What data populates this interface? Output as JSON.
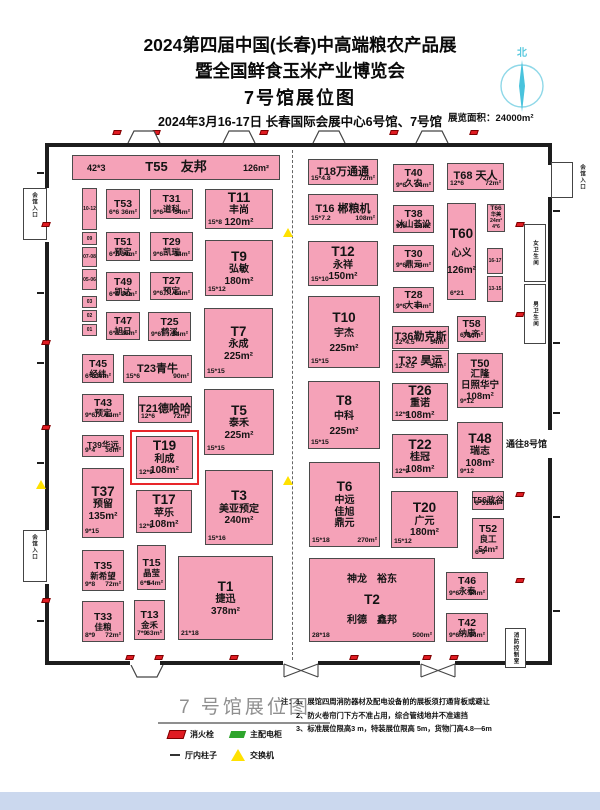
{
  "header": {
    "title_line1": "2024第四届中国(长春)中高端粮农产品展",
    "title_line2": "暨全国鲜食玉米产业博览会",
    "title_line3": "7号馆展位图",
    "date_line": "2024年3月16-17日  长春国际会展中心6号馆、7号馆",
    "area_label": "展览面积：24000m²",
    "compass_label": "北"
  },
  "plan": {
    "booth_fill": "#f5a2b8",
    "highlight_color": "#e8262a",
    "passage_label": "通往8号馆",
    "booths": [
      {
        "id": "T55",
        "x": 72,
        "y": 155,
        "w": 208,
        "h": 25,
        "cls": "banner",
        "lines": [
          "T55　友邦"
        ],
        "bl": "42*3",
        "br": "126m²"
      },
      {
        "id": "T53",
        "x": 106,
        "y": 189,
        "w": 34,
        "h": 30,
        "cls": "s",
        "lines": [
          "T53"
        ],
        "bl": "6*6",
        "br": "36m²"
      },
      {
        "id": "T51",
        "x": 106,
        "y": 232,
        "w": 34,
        "h": 29,
        "cls": "s",
        "lines": [
          "T51",
          "预定"
        ],
        "bl": "6*6",
        "br": "36m²"
      },
      {
        "id": "T49",
        "x": 106,
        "y": 272,
        "w": 34,
        "h": 29,
        "cls": "s",
        "lines": [
          "T49",
          "凯达"
        ],
        "bl": "6*6",
        "br": "36m²"
      },
      {
        "id": "T47",
        "x": 106,
        "y": 312,
        "w": 34,
        "h": 28,
        "cls": "s",
        "lines": [
          "T47",
          "旭日"
        ],
        "bl": "6*6",
        "br": "36m²"
      },
      {
        "id": "T45",
        "x": 82,
        "y": 354,
        "w": 32,
        "h": 29,
        "cls": "s",
        "lines": [
          "T45",
          "经纬"
        ],
        "bl": "6*6",
        "br": "36m²"
      },
      {
        "id": "T43",
        "x": 82,
        "y": 394,
        "w": 42,
        "h": 28,
        "cls": "s",
        "lines": [
          "T43",
          "预定"
        ],
        "bl": "9*6",
        "br": "54m²"
      },
      {
        "id": "T39",
        "x": 82,
        "y": 435,
        "w": 42,
        "h": 22,
        "cls": "tiny2",
        "lines": [
          "T39华远"
        ],
        "bl": "9*4",
        "br": "36m²"
      },
      {
        "id": "T37",
        "x": 82,
        "y": 468,
        "w": 42,
        "h": 70,
        "cls": "l",
        "lines": [
          "T37",
          "预留",
          "135m²"
        ],
        "bl": "9*15"
      },
      {
        "id": "T35",
        "x": 82,
        "y": 550,
        "w": 42,
        "h": 41,
        "cls": "s",
        "lines": [
          "T35",
          "新希望"
        ],
        "bl": "9*8",
        "br": "72m²"
      },
      {
        "id": "T33",
        "x": 82,
        "y": 601,
        "w": 42,
        "h": 41,
        "cls": "s",
        "lines": [
          "T33",
          "佳粮"
        ],
        "bl": "8*9",
        "br": "72m²"
      },
      {
        "id": "T31",
        "x": 150,
        "y": 189,
        "w": 43,
        "h": 30,
        "cls": "s",
        "lines": [
          "T31",
          "道科"
        ],
        "bl": "9*6",
        "br": "54m²"
      },
      {
        "id": "T29",
        "x": 150,
        "y": 232,
        "w": 43,
        "h": 29,
        "cls": "s",
        "lines": [
          "T29",
          "凯瑞"
        ],
        "bl": "9*6",
        "br": "54m²"
      },
      {
        "id": "T27",
        "x": 150,
        "y": 272,
        "w": 43,
        "h": 28,
        "cls": "s",
        "lines": [
          "T27",
          "预定"
        ],
        "bl": "9*6",
        "br": "54m²"
      },
      {
        "id": "T25",
        "x": 148,
        "y": 312,
        "w": 43,
        "h": 29,
        "cls": "s",
        "lines": [
          "T25",
          "鹤溪"
        ],
        "bl": "9*6",
        "br": "54m²"
      },
      {
        "id": "T23",
        "x": 123,
        "y": 355,
        "w": 69,
        "h": 28,
        "cls": "m",
        "lines": [
          "T23青牛"
        ],
        "bl": "15*6",
        "br": "90m²"
      },
      {
        "id": "T21",
        "x": 138,
        "y": 396,
        "w": 54,
        "h": 27,
        "cls": "m",
        "lines": [
          "T21德哈哈"
        ],
        "bl": "12*6",
        "br": "72m²"
      },
      {
        "id": "T19",
        "x": 136,
        "y": 436,
        "w": 57,
        "h": 43,
        "cls": "l",
        "hl": true,
        "lines": [
          "T19",
          "利成",
          "108m²"
        ],
        "bl": "12*9"
      },
      {
        "id": "T17",
        "x": 136,
        "y": 490,
        "w": 56,
        "h": 43,
        "cls": "l",
        "lines": [
          "T17",
          "苹乐",
          "108m²"
        ],
        "bl": "12*9"
      },
      {
        "id": "T15",
        "x": 137,
        "y": 545,
        "w": 29,
        "h": 45,
        "cls": "s",
        "lines": [
          "T15",
          "晶莹"
        ],
        "bl": "6*9",
        "br": "54m²"
      },
      {
        "id": "T13",
        "x": 134,
        "y": 600,
        "w": 31,
        "h": 40,
        "cls": "s",
        "lines": [
          "T13",
          "金禾"
        ],
        "bl": "7*9",
        "br": "63m²"
      },
      {
        "id": "T11",
        "x": 205,
        "y": 189,
        "w": 68,
        "h": 40,
        "cls": "l",
        "lines": [
          "T11",
          "丰尚",
          "120m²"
        ],
        "bl": "15*8"
      },
      {
        "id": "T9",
        "x": 205,
        "y": 240,
        "w": 68,
        "h": 56,
        "cls": "l",
        "lines": [
          "T9",
          "弘敏",
          "180m²"
        ],
        "bl": "15*12"
      },
      {
        "id": "T7",
        "x": 204,
        "y": 308,
        "w": 69,
        "h": 70,
        "cls": "l",
        "lines": [
          "T7",
          "永成",
          "225m²"
        ],
        "bl": "15*15"
      },
      {
        "id": "T5",
        "x": 204,
        "y": 389,
        "w": 70,
        "h": 66,
        "cls": "l",
        "lines": [
          "T5",
          "泰禾",
          "225m²"
        ],
        "bl": "15*15"
      },
      {
        "id": "T3",
        "x": 205,
        "y": 470,
        "w": 68,
        "h": 75,
        "cls": "l",
        "lines": [
          "T3",
          "美亚预定",
          "240m²"
        ],
        "bl": "15*16"
      },
      {
        "id": "T1",
        "x": 178,
        "y": 556,
        "w": 95,
        "h": 84,
        "cls": "l",
        "lines": [
          "T1",
          "捷迅",
          "378m²"
        ],
        "bl": "21*18"
      },
      {
        "id": "T18",
        "x": 308,
        "y": 159,
        "w": 70,
        "h": 26,
        "cls": "m",
        "lines": [
          "T18万通通"
        ],
        "bl": "15*4.8",
        "br": "72m²"
      },
      {
        "id": "T40",
        "x": 393,
        "y": 164,
        "w": 41,
        "h": 28,
        "cls": "s",
        "lines": [
          "T40",
          "久农"
        ],
        "bl": "9*6",
        "br": "54m²"
      },
      {
        "id": "T68",
        "x": 447,
        "y": 163,
        "w": 57,
        "h": 27,
        "cls": "m",
        "lines": [
          "T68 天人"
        ],
        "bl": "12*6",
        "br": "72m²"
      },
      {
        "id": "T16",
        "x": 308,
        "y": 194,
        "w": 70,
        "h": 31,
        "cls": "m",
        "lines": [
          "T16 郴粮机"
        ],
        "bl": "15*7.2",
        "br": "108m²"
      },
      {
        "id": "T38",
        "x": 393,
        "y": 205,
        "w": 41,
        "h": 28,
        "cls": "s",
        "lines": [
          "T38",
          "冰山荟设"
        ],
        "bl": "9*6",
        "br": "54m²"
      },
      {
        "id": "T66",
        "x": 487,
        "y": 204,
        "w": 18,
        "h": 28,
        "cls": "tiny",
        "lines": [
          "T66",
          "华美",
          "24m²",
          "4*6"
        ]
      },
      {
        "id": "T60",
        "x": 447,
        "y": 203,
        "w": 29,
        "h": 97,
        "cls": "l",
        "lines": [
          "T60",
          "心义",
          "126m²"
        ],
        "bl": "6*21",
        "gap": 6
      },
      {
        "id": "T12",
        "x": 308,
        "y": 241,
        "w": 70,
        "h": 45,
        "cls": "l",
        "lines": [
          "T12",
          "永祥",
          "150m²"
        ],
        "bl": "15*10"
      },
      {
        "id": "T30",
        "x": 393,
        "y": 245,
        "w": 41,
        "h": 27,
        "cls": "s",
        "lines": [
          "T30",
          "鼎元"
        ],
        "bl": "9*6",
        "br": "54m²"
      },
      {
        "id": "T28",
        "x": 393,
        "y": 287,
        "w": 41,
        "h": 26,
        "cls": "s",
        "lines": [
          "T28",
          "大丰"
        ],
        "bl": "9*6",
        "br": "54m²"
      },
      {
        "id": "T10",
        "x": 308,
        "y": 296,
        "w": 72,
        "h": 72,
        "cls": "l",
        "lines": [
          "T10",
          "宇杰",
          "225m²"
        ],
        "bl": "15*15",
        "gap": 3
      },
      {
        "id": "T36",
        "x": 392,
        "y": 326,
        "w": 57,
        "h": 23,
        "cls": "m",
        "lines": [
          "T36勒克斯"
        ],
        "bl": "12*4.5",
        "br": "54m²"
      },
      {
        "id": "T32",
        "x": 392,
        "y": 350,
        "w": 57,
        "h": 23,
        "cls": "m",
        "lines": [
          "T32 昊运"
        ],
        "bl": "12*4.5",
        "br": "54m²"
      },
      {
        "id": "T58",
        "x": 457,
        "y": 316,
        "w": 29,
        "h": 26,
        "cls": "s",
        "lines": [
          "T58",
          "九齐"
        ],
        "bl": "6*6",
        "br": "36m²"
      },
      {
        "id": "T50",
        "x": 457,
        "y": 353,
        "w": 46,
        "h": 55,
        "cls": "m",
        "lines": [
          "T50",
          "汇隆",
          "日照华宁",
          "108m²"
        ],
        "bl": "9*12"
      },
      {
        "id": "T8",
        "x": 308,
        "y": 381,
        "w": 72,
        "h": 68,
        "cls": "l",
        "lines": [
          "T8",
          "中科",
          "225m²"
        ],
        "bl": "15*15",
        "gap": 3
      },
      {
        "id": "T26",
        "x": 392,
        "y": 383,
        "w": 56,
        "h": 38,
        "cls": "l",
        "lines": [
          "T26",
          "重诺",
          "108m²"
        ],
        "bl": "12*9"
      },
      {
        "id": "T22",
        "x": 392,
        "y": 434,
        "w": 56,
        "h": 44,
        "cls": "l",
        "lines": [
          "T22",
          "桂冠",
          "108m²"
        ],
        "bl": "12*9"
      },
      {
        "id": "T48",
        "x": 457,
        "y": 422,
        "w": 46,
        "h": 56,
        "cls": "l",
        "lines": [
          "T48",
          "瑞志",
          "108m²"
        ],
        "bl": "9*12"
      },
      {
        "id": "T6",
        "x": 309,
        "y": 462,
        "w": 71,
        "h": 85,
        "cls": "l",
        "lines": [
          "T6",
          "中远",
          "佳旭",
          "鼎元"
        ],
        "bl": "15*18",
        "br": "270m²"
      },
      {
        "id": "T20",
        "x": 391,
        "y": 491,
        "w": 67,
        "h": 57,
        "cls": "l",
        "lines": [
          "T20",
          "广元",
          "180m²"
        ],
        "bl": "15*12"
      },
      {
        "id": "T56",
        "x": 472,
        "y": 491,
        "w": 32,
        "h": 19,
        "cls": "tiny2",
        "lines": [
          "T56政谷"
        ],
        "bl": "6*3",
        "br": "18m²"
      },
      {
        "id": "T52",
        "x": 472,
        "y": 518,
        "w": 32,
        "h": 41,
        "cls": "s",
        "lines": [
          "T52",
          "良工",
          "54m²"
        ],
        "bl": "6*9"
      },
      {
        "id": "T2",
        "x": 309,
        "y": 558,
        "w": 126,
        "h": 84,
        "cls": "l",
        "lines": [
          "神龙　裕东",
          "T2",
          "利德　鑫邦"
        ],
        "bl": "28*18",
        "br": "500m²",
        "gap": 7
      },
      {
        "id": "T46",
        "x": 446,
        "y": 572,
        "w": 42,
        "h": 28,
        "cls": "s",
        "lines": [
          "T46",
          "永泰"
        ],
        "bl": "9*6",
        "br": "54m²"
      },
      {
        "id": "T42",
        "x": 446,
        "y": 613,
        "w": 42,
        "h": 29,
        "cls": "s",
        "lines": [
          "T42",
          "纳康"
        ],
        "bl": "9*6",
        "br": "54m²"
      }
    ],
    "strip_cells": [
      {
        "label": "10-12",
        "x": 82,
        "y": 188,
        "w": 15,
        "h": 42
      },
      {
        "label": "09",
        "x": 82,
        "y": 232,
        "w": 15,
        "h": 13
      },
      {
        "label": "07-08",
        "x": 82,
        "y": 247,
        "w": 15,
        "h": 20
      },
      {
        "label": "05-06",
        "x": 82,
        "y": 269,
        "w": 15,
        "h": 21
      },
      {
        "label": "03",
        "x": 82,
        "y": 296,
        "w": 15,
        "h": 12
      },
      {
        "label": "02",
        "x": 82,
        "y": 310,
        "w": 15,
        "h": 12
      },
      {
        "label": "01",
        "x": 82,
        "y": 324,
        "w": 15,
        "h": 12
      },
      {
        "label": "16-17",
        "x": 487,
        "y": 248,
        "w": 16,
        "h": 26
      },
      {
        "label": "13-15",
        "x": 487,
        "y": 276,
        "w": 16,
        "h": 26
      }
    ],
    "rooms": [
      {
        "label": "女卫生间",
        "x": 524,
        "y": 224,
        "w": 22,
        "h": 58
      },
      {
        "label": "男卫生间",
        "x": 524,
        "y": 284,
        "w": 22,
        "h": 60
      },
      {
        "label": "消防控制室",
        "x": 505,
        "y": 628,
        "w": 21,
        "h": 40
      }
    ],
    "entrance_labels": [
      {
        "label": "会馆入口",
        "x": 30,
        "y": 192
      },
      {
        "label": "会馆入口",
        "x": 30,
        "y": 534
      },
      {
        "label": "会馆入口",
        "x": 578,
        "y": 164
      }
    ],
    "passage": {
      "x": 506,
      "y": 437
    },
    "hydrants": [
      [
        113,
        130
      ],
      [
        152,
        130
      ],
      [
        260,
        130
      ],
      [
        390,
        130
      ],
      [
        470,
        130
      ],
      [
        42,
        222
      ],
      [
        42,
        340
      ],
      [
        42,
        425
      ],
      [
        42,
        598
      ],
      [
        516,
        222
      ],
      [
        516,
        312
      ],
      [
        516,
        492
      ],
      [
        516,
        578
      ],
      [
        126,
        655
      ],
      [
        155,
        655
      ],
      [
        230,
        655
      ],
      [
        350,
        655
      ],
      [
        423,
        655
      ],
      [
        450,
        655
      ]
    ],
    "switches": [
      [
        283,
        228
      ],
      [
        283,
        476
      ],
      [
        36,
        480
      ]
    ],
    "top_doors": [
      127,
      222,
      312,
      415
    ],
    "bottom_trap_doors": [
      130
    ],
    "bottom_x_doors": [
      283,
      420
    ],
    "ticks": [
      [
        37,
        172
      ],
      [
        37,
        292
      ],
      [
        37,
        362
      ],
      [
        37,
        462
      ],
      [
        37,
        620
      ],
      [
        553,
        210
      ],
      [
        553,
        342
      ],
      [
        553,
        412
      ],
      [
        553,
        516
      ],
      [
        553,
        610
      ]
    ]
  },
  "legend": {
    "title": "7 号馆展位图",
    "items": [
      {
        "icon": "fire-hydrant",
        "label": "消火栓"
      },
      {
        "icon": "main-power-cabinet",
        "label": "主配电柜"
      },
      {
        "icon": "hall-column",
        "label": "厅内柱子"
      },
      {
        "icon": "network-switch",
        "label": "交换机"
      }
    ],
    "notes_prefix": "注：",
    "notes": [
      "1、展馆四周消防器材及配电设备前的展板须打通背板或避让",
      "2、防火卷帘门下方不准占用，综合管线地井不准遮挡",
      "3、标准展位限高3 m，特装展位限高 5m，货物门高4.8—6m"
    ]
  }
}
